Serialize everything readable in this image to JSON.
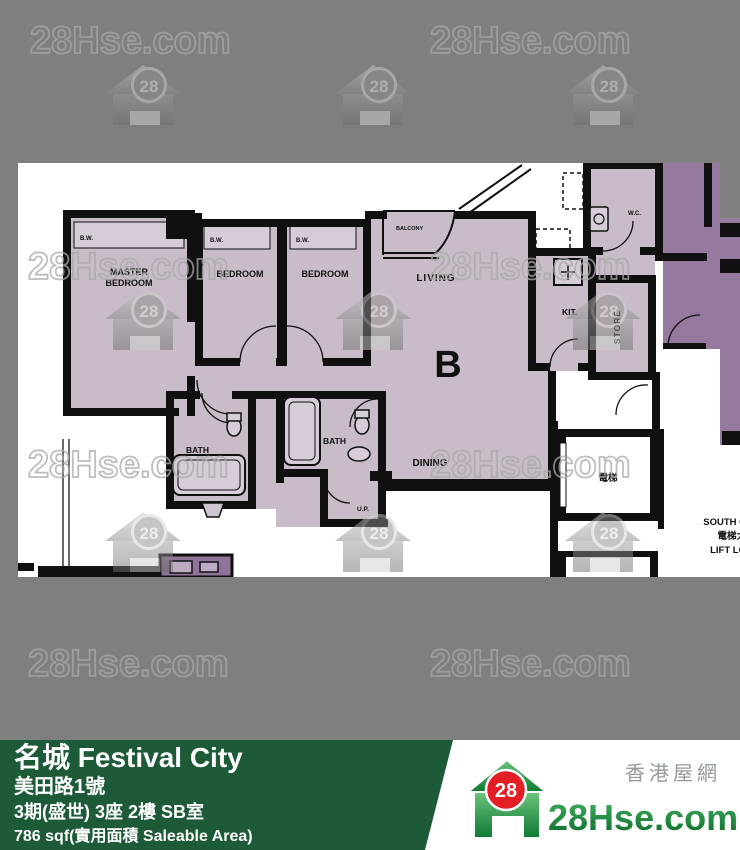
{
  "watermark": {
    "text": "28Hse.com",
    "badge": "28"
  },
  "floor_plan": {
    "unit_label": "B",
    "labels": {
      "master_line1": "MASTER",
      "master_line2": "BEDROOM",
      "bedroom": "BEDROOM",
      "living": "LIVING",
      "dining": "DINING",
      "kitchen": "KIT.",
      "store": "STORE",
      "bath": "BATH",
      "balcony": "BALCONY",
      "bay_window": "B.W.",
      "utility_platform": "U.P.",
      "wc": "W.C.",
      "lift": "電梯",
      "lobby_line1": "SOUTH C",
      "lobby_line2": "電梯大",
      "lobby_line3": "LIFT LO"
    }
  },
  "banner": {
    "title": "名城 Festival City",
    "address": "美田路1號",
    "unit_info": "3期(盛世) 3座 2樓 SB室",
    "area_info": "786 sqf(實用面積 Saleable Area)"
  },
  "footer_logo": {
    "site": "28Hse.com",
    "badge": "28",
    "tagline": "香港屋網"
  },
  "colors": {
    "background": "#7f7f7f",
    "banner_green": "#1d5a37",
    "logo_green": "#12893a",
    "logo_red": "#e31e24",
    "room_fill": "#c8bcc9",
    "adjacent_fill": "#96799e",
    "wall": "#101010"
  }
}
